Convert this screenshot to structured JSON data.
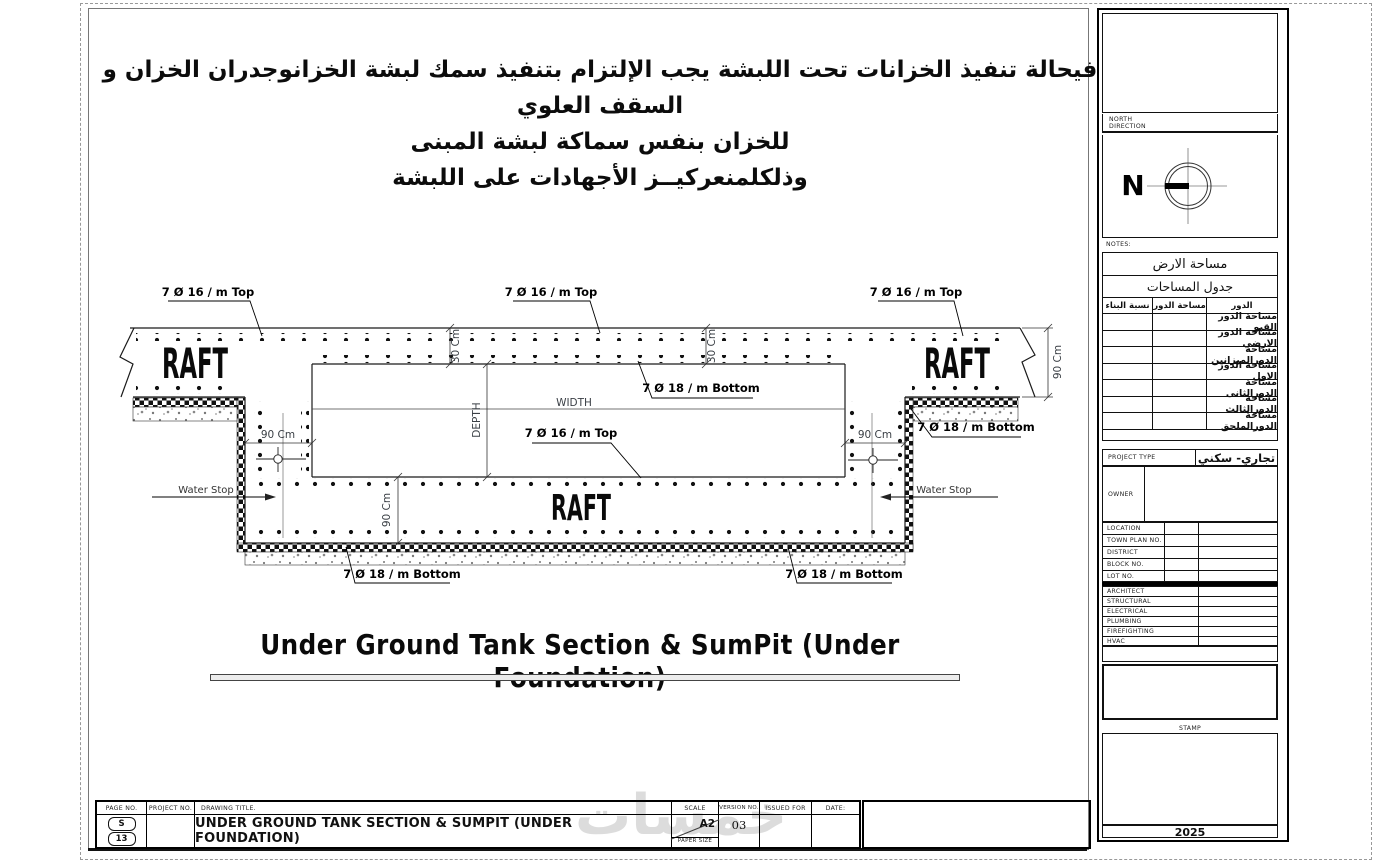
{
  "top_notes": {
    "line1": "فيحالة تنفيذ الخزانات تحت اللبشة يجب الإلتزام بتنفيذ سمك لبشة الخزانوجدران الخزان و السقف العلوي",
    "line2": "للخزان بنفس سماكة لبشة المبنى",
    "line3": "وذلكلمنعركيــز الأجهادات على اللبشة"
  },
  "drawing": {
    "title": "Under Ground Tank Section & SumPit (Under Foundation)",
    "labels": {
      "rebar_top": "7 Ø 16  / m Top",
      "rebar_bottom": "7 Ø 18  / m Bottom",
      "raft": "RAFT",
      "water_stop": "Water Stop"
    },
    "dims": {
      "wall_thickness": "90 Cm",
      "slab_thickness": "30 Cm",
      "depth": "DEPTH",
      "width": "WIDTH"
    }
  },
  "sidebar": {
    "north_line1": "NORTH",
    "north_line2": "DIRECTION",
    "compass_n": "N",
    "notes_label": "NOTES:",
    "land_area": "مساحة الارض",
    "areas_title": "جدول المساحات",
    "table": {
      "col_ratio": "نسبة البناء",
      "col_area": "مساحة الدور",
      "col_floor": "الدور",
      "rows": [
        "مساحة الدور القبو",
        "مساحة الدور الارضي",
        "مساحة الدورالميزانين",
        "مساحة الدور الاول",
        "مساحة الدورالثانى",
        "مساحة الدورالثالث",
        "مساحة الدورالملحق"
      ]
    },
    "project_type_label": "PROJECT TYPE",
    "project_type_value": "تجاري- سكني",
    "owner_label": "OWNER",
    "info_rows": [
      "LOCATION",
      "TOWN PLAN NO.",
      "DISTRICT",
      "BLOCK NO.",
      "LOT NO."
    ],
    "disciplines": [
      "ARCHITECT",
      "STRUCTURAL",
      "ELECTRICAL",
      "PLUMBING",
      "FIREFIGHTING",
      "HVAC"
    ],
    "stamp_label": "STAMP",
    "year": "2025"
  },
  "titleblock": {
    "page_no_label": "PAGE NO.",
    "project_no_label": "PROJECT NO.",
    "drawing_title_label": "DRAWING TITLE.",
    "drawing_title": "UNDER GROUND TANK SECTION & SUMPIT (UNDER FOUNDATION)",
    "scale_label": "SCALE",
    "paper_size_label": "PAPER SIZE",
    "paper_size": "A2",
    "version_label": "VERSION NO.",
    "version_value": "03",
    "issued_for_label": "ISSUED FOR",
    "date_label": "DATE:",
    "page_letter": "S",
    "page_number": "13"
  },
  "watermark": "خمسات"
}
